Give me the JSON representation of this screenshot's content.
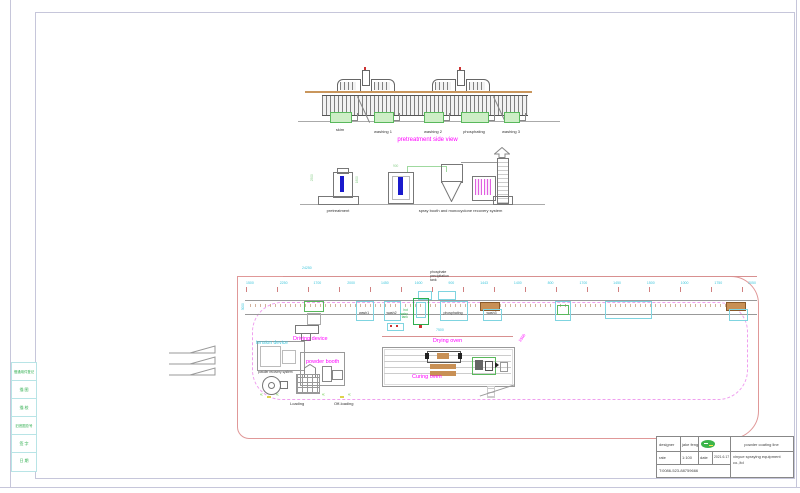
{
  "colors": {
    "magenta": "#ff00ff",
    "cyan_dim": "#3ec6dc",
    "green": "#2fae4e",
    "tan": "#c89055",
    "pink_outline": "#e09898",
    "booth_blue": "#1a1acc",
    "frame": "#c6c6da",
    "logo_green": "#3cb54a"
  },
  "side_view": {
    "title": "pretreatment side view",
    "stations": [
      "skim",
      "washing 1",
      "washing 2",
      "phosphating",
      "washing 3"
    ]
  },
  "elevations": {
    "pretreatment_label": "pretreatment",
    "booth_label": "spray booth and monocyclone recovery system",
    "pre_dim_left": "2500",
    "pre_dim_right": "1800",
    "booth_dim": "900"
  },
  "plan": {
    "overall_dim": "24250",
    "dims": [
      "1500",
      "2250",
      "1700",
      "2000",
      "1450",
      "1600",
      "900",
      "1443",
      "1400",
      "800",
      "1700",
      "1450",
      "1500",
      "1000",
      "1750",
      "2050"
    ],
    "left_dim": "3000",
    "phosphate_tank": {
      "line1": "phosphate",
      "line2": "precipitation",
      "line3": "tank"
    },
    "hot_tank": {
      "line1": "hot",
      "line2": "water",
      "line3": "tank"
    },
    "tanks": [
      "wash1",
      "wash2",
      "phosphating",
      "wash3"
    ],
    "tension_label": "tension device",
    "driving_label": "Driving device",
    "powder_booth_label": "powder booth",
    "powder_recovery_label": "powder recovery system",
    "loading_label": "Loading",
    "offloading_label": "Off-loading",
    "drying_label": "Drying oven",
    "curing_label": "Curing oven",
    "drying_dim": "7500",
    "diag_dim": "1500"
  },
  "left_strip": {
    "rows": [
      "借通用件登记",
      "描 图",
      "描 校",
      "旧底图总号",
      "签 字",
      "日 期"
    ]
  },
  "title_block": {
    "designer_label": "designer",
    "designer_value": "jake feng",
    "rate_label": "rate",
    "rate_value": "1:100",
    "date_label": "date",
    "date_value": "2021.6.17",
    "product": "powder coating line",
    "company": "xinyue spraying equipment co.,ltd",
    "phone": "T:0086-523-88759666"
  }
}
